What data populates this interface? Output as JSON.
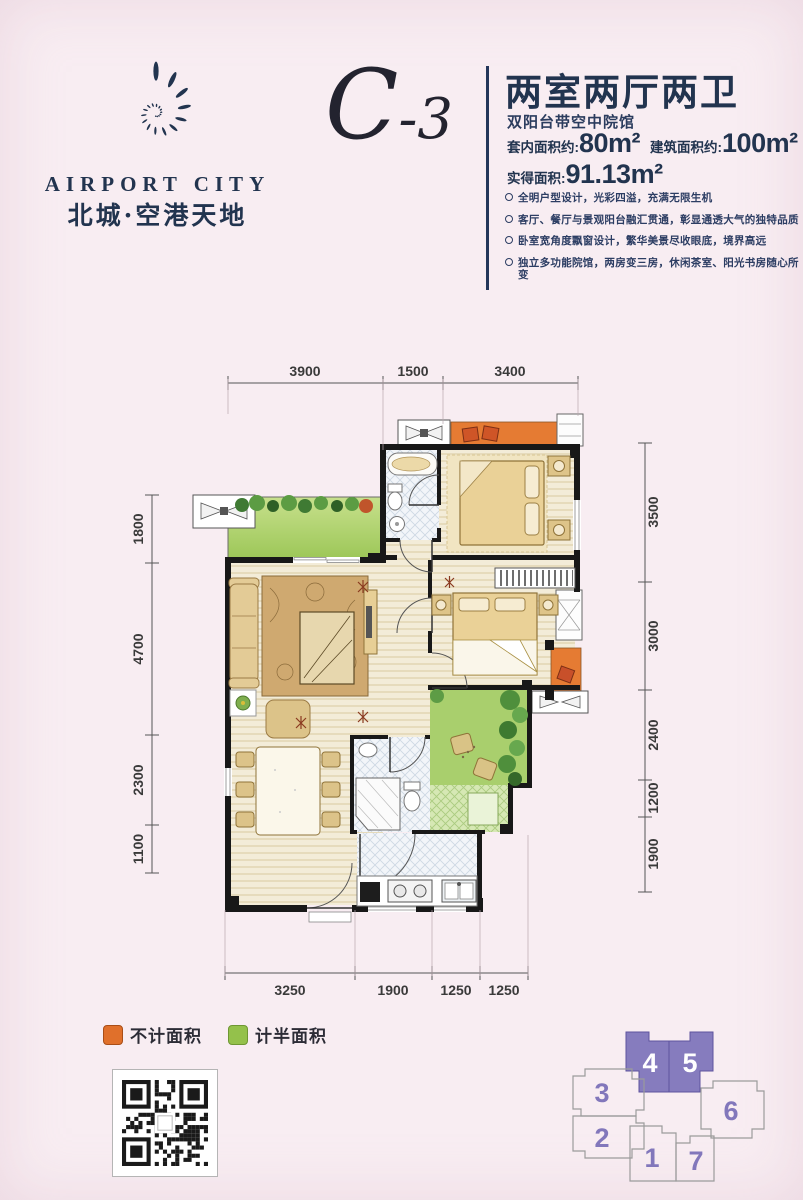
{
  "brand": {
    "name_en": "AIRPORT CITY",
    "name_cn": "北城·空港天地",
    "navy": "#22344f"
  },
  "unit": {
    "code_main": "C",
    "code_suffix": "-3",
    "title": "两室两厅两卫",
    "subtitle": "双阳台带空中院馆",
    "area_inner_label": "套内面积约:",
    "area_inner_value": "80m²",
    "area_build_label": "建筑面积约:",
    "area_build_value": "100m²",
    "area_actual_label": "实得面积:",
    "area_actual_value": "91.13m²",
    "features": [
      "全明户型设计，光彩四溢，充满无限生机",
      "客厅、餐厅与景观阳台融汇贯通，彰显通透大气的独特品质",
      "卧室宽角度飘窗设计，繁华美景尽收眼底，境界高远",
      "独立多功能院馆，两房变三房，休闲茶室、阳光书房随心所变"
    ]
  },
  "plan": {
    "dims_top": [
      "3900",
      "1500",
      "3400"
    ],
    "dims_left": [
      "1800",
      "4700",
      "2300",
      "1100"
    ],
    "dims_right": [
      "3500",
      "3000",
      "2400",
      "1200",
      "1900"
    ],
    "dims_bottom": [
      "3250",
      "1900",
      "1250",
      "1250"
    ]
  },
  "legend": {
    "not_counted": "不计面积",
    "half_counted": "计半面积",
    "orange": "#e0702b",
    "green": "#94c14b"
  },
  "key_plan": {
    "highlight_color": "#867cbe",
    "units": [
      {
        "label": "4",
        "highlighted": true
      },
      {
        "label": "5",
        "highlighted": true
      },
      {
        "label": "3",
        "highlighted": false
      },
      {
        "label": "2",
        "highlighted": false
      },
      {
        "label": "6",
        "highlighted": false
      },
      {
        "label": "1",
        "highlighted": false
      },
      {
        "label": "7",
        "highlighted": false
      }
    ]
  }
}
